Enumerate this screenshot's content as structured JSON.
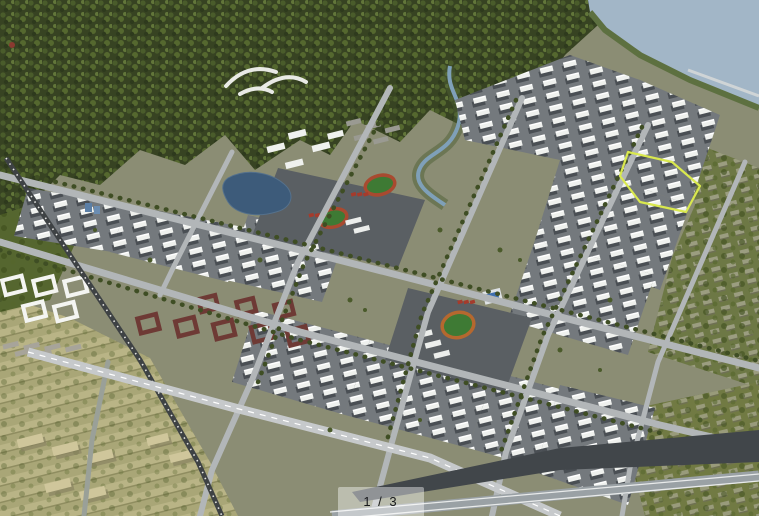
{
  "window": {
    "width": 759,
    "height": 516
  },
  "image": {
    "type": "aerial-architectural-rendering",
    "description": "Bird's-eye rendering of a planned new town: dark forested hills across the top-left, a large lake in the top-right corner, dense rows of white high-rise residential slabs on grey blocks, school campuses with red-and-green running tracks, a pond with campus buildings, maroon courtyard housing, white landmark buildings at the left, farmland with sheds in the bottom-left, a railway and elevated expressway crossing the fields, a light-rail line along the bottom edge, and one parcel outlined in yellow-green near the right",
    "landmarks": [
      "forest-hills",
      "lake",
      "shoreline-pier",
      "upper-residential-district",
      "mid-left-residential-blocks",
      "center-residential-blocks",
      "right-residential-blocks",
      "bottom-right-towers",
      "school-campus-north",
      "running-track-1",
      "running-track-2",
      "school-campus-south",
      "running-track-3",
      "swimming-pool-hall",
      "campus-pond",
      "canal-stream",
      "white-landmark-buildings",
      "maroon-courtyard-cluster",
      "forest-village",
      "hillside-resort",
      "farmland",
      "farm-sheds",
      "village-rows",
      "green-village-east",
      "green-village-southeast",
      "railway",
      "elevated-expressway",
      "light-rail",
      "country-road",
      "highlighted-parcel",
      "commercial-roof-strip"
    ]
  },
  "pagination": {
    "display": "1 / 3",
    "current": 1,
    "total": 3
  },
  "palette": {
    "forest": "#374322",
    "forest_light": "#62763a",
    "water": "#a2b6c7",
    "farmland": "#a9a677",
    "road": "#b2b6b8",
    "building_white": "#eff1ee",
    "block_ground": "#74797d",
    "track_ring_red": "#a84a30",
    "track_field_green": "#3e7a34",
    "court_red": "#a53b2c",
    "pond_blue": "#3d5b7a",
    "courtyard_maroon": "#6e3a35",
    "parcel_highlight": "#d9e84e",
    "overlay_bg": "rgba(255,255,255,0.42)",
    "overlay_text": "#17191c"
  }
}
